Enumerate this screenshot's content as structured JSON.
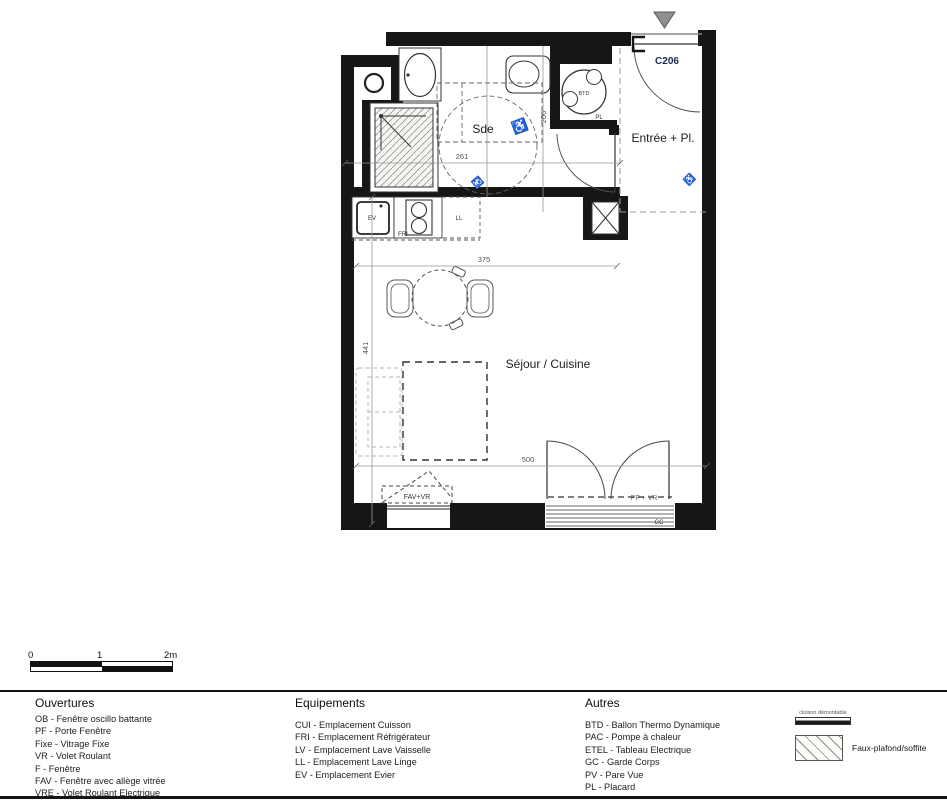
{
  "colors": {
    "wall": "#161616",
    "line": "#3c3c3c",
    "dashed": "#8a8a8a",
    "dim": "#555555",
    "unit_accent": "#1b2a52",
    "triangle": "#8f8f8f"
  },
  "plan": {
    "unit_label": "C206",
    "room_labels": {
      "bathroom": "Sde",
      "entry": "Entrée + Pl.",
      "living": "Séjour / Cuisine"
    },
    "equipment_labels": {
      "btd": "BTD",
      "pl": "PL",
      "ev": "EV",
      "fri": "FRI",
      "ll": "LL"
    },
    "window_labels": {
      "fav": "FAV+VR",
      "pf": "PF + VR",
      "gc": "GC"
    },
    "dimensions": {
      "sde_width": "261",
      "sde_height": "206",
      "living_width": "375",
      "living_height": "441",
      "living_width_bottom": "500"
    }
  },
  "scalebar": {
    "t0": "0",
    "t1": "1",
    "t2": "2m"
  },
  "legend": {
    "openings": {
      "title": "Ouvertures",
      "items": [
        "OB - Fenêtre oscillo battante",
        "PF - Porte Fenêtre",
        "Fixe - Vitrage Fixe",
        "VR - Volet Roulant",
        "F - Fenêtre",
        "FAV - Fenêtre avec allège vitrée",
        "VRE - Volet Roulant Electrique"
      ]
    },
    "equipment": {
      "title": "Equipements",
      "items": [
        "CUI - Emplacement Cuisson",
        "FRI - Emplacement Réfrigérateur",
        "LV - Emplacement Lave Vaisselle",
        "LL - Emplacement Lave Linge",
        "EV - Emplacement Evier"
      ]
    },
    "others": {
      "title": "Autres",
      "items": [
        "BTD - Ballon Thermo Dynamique",
        "PAC - Pompe à chaleur",
        "ETEL - Tableau Electrique",
        "GC - Garde Corps",
        "PV - Pare Vue",
        "PL - Placard"
      ]
    },
    "symbols": {
      "partition": "cloison démontable",
      "false_ceiling": "Faux-plafond/soffite"
    }
  }
}
